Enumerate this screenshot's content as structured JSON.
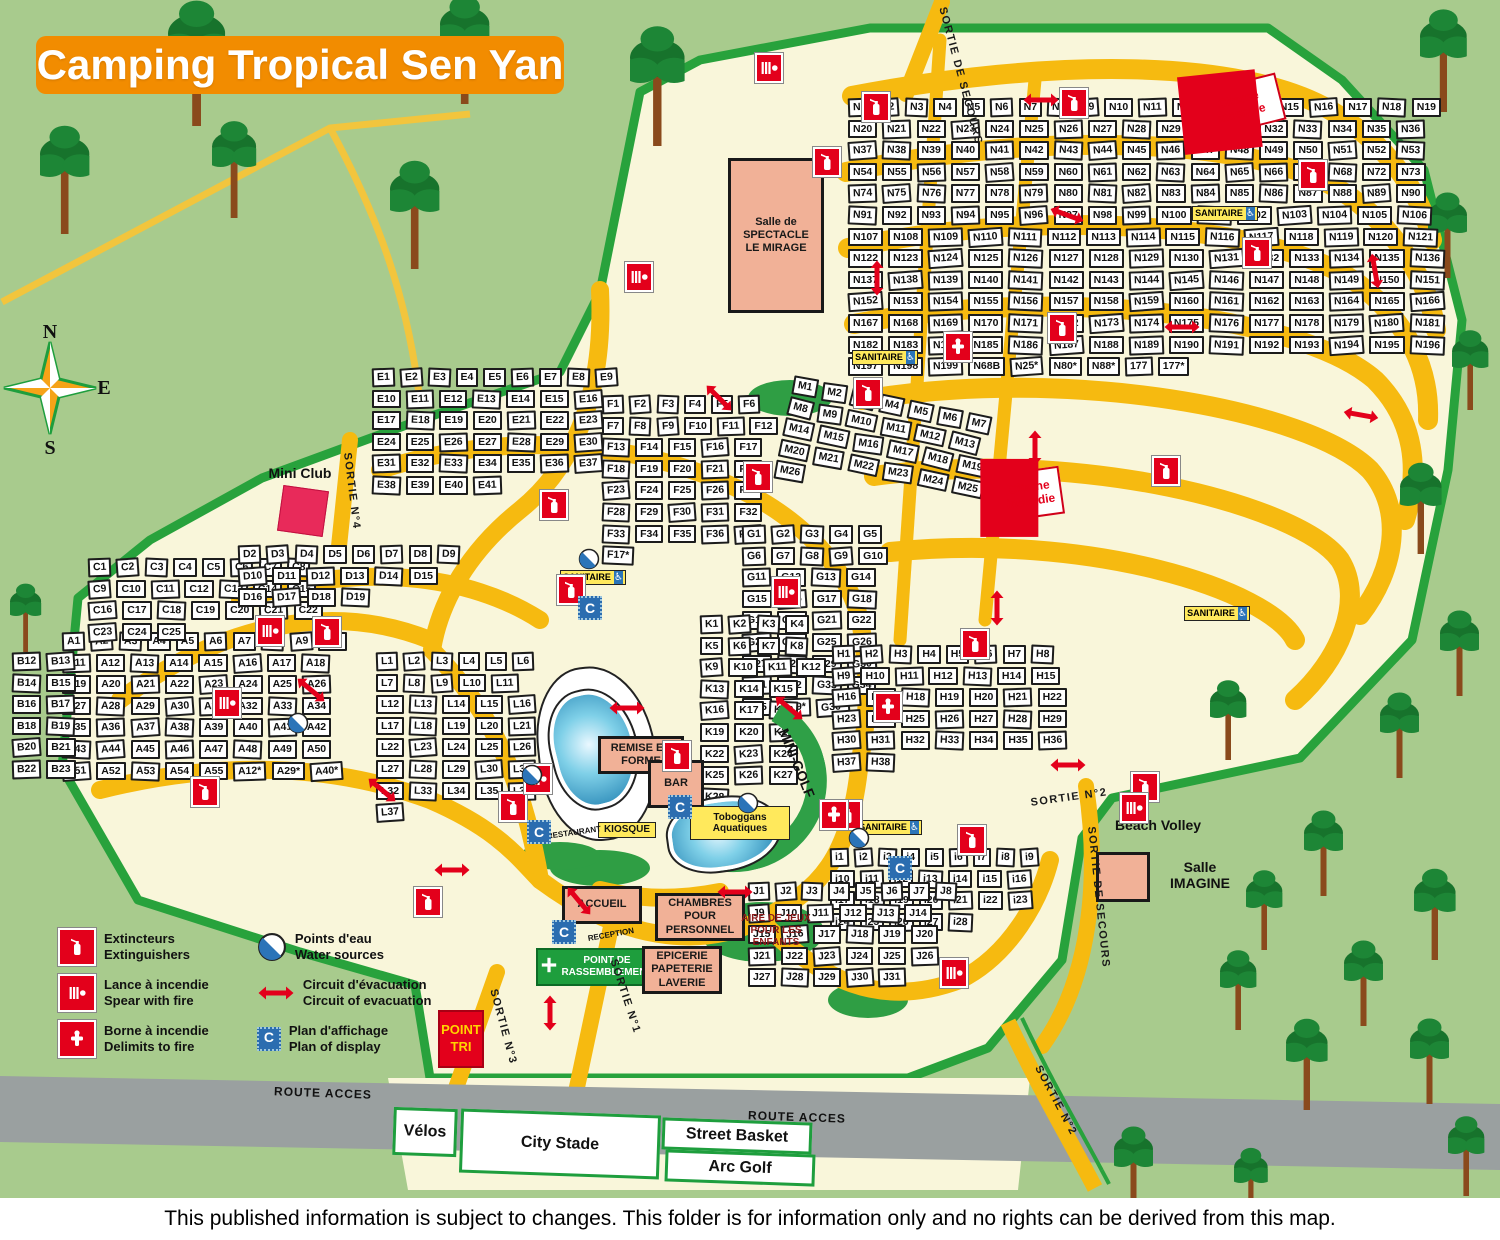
{
  "title": "Camping Tropical Sen Yan",
  "footer": "This published information is subject to changes. This folder is for information only and no rights can be derived from this map.",
  "compass": {
    "n": "N",
    "e": "E",
    "s": "S"
  },
  "icons": {
    "display_plan_glyph": "C",
    "handicap_glyph": "♿"
  },
  "colors": {
    "grass": "#a8cb8d",
    "cream": "#f9f6da",
    "road_yellow": "#f6ba10",
    "road_grey": "#9aa0a0",
    "boundary_green": "#28a23c",
    "accent_red": "#e3001b",
    "building_salmon": "#f1b197",
    "title_orange": "#f28c00",
    "badge_blue": "#2b6db0"
  },
  "legend": {
    "items": [
      {
        "icon": "extinguisher-icon",
        "fr": "Extincteurs",
        "en": "Extinguishers"
      },
      {
        "icon": "fire-lance-icon",
        "fr": "Lance à incendie",
        "en": "Spear with fire"
      },
      {
        "icon": "fire-hydrant-icon",
        "fr": "Borne à incendie",
        "en": "Delimits to fire"
      },
      {
        "icon": "water-point-icon",
        "fr": "Points d'eau",
        "en": "Water sources"
      },
      {
        "icon": "evacuation-arrow-icon",
        "fr": "Circuit d'évacuation",
        "en": "Circuit of evacuation"
      },
      {
        "icon": "display-plan-icon",
        "fr": "Plan d'affichage",
        "en": "Plan of display"
      }
    ]
  },
  "zones": [
    {
      "id": "zone-a",
      "letter": "A",
      "x": 62,
      "y": 632,
      "w": 300,
      "h": 330,
      "rot": 0,
      "ranges": [
        [
          1,
          55
        ]
      ],
      "specials": [
        "A12*",
        "A29*",
        "A40*"
      ]
    },
    {
      "id": "zone-b",
      "letter": "B",
      "x": 12,
      "y": 652,
      "w": 80,
      "h": 235,
      "rot": 0,
      "ranges": [
        [
          12,
          23
        ]
      ],
      "specials": []
    },
    {
      "id": "zone-c",
      "letter": "C",
      "x": 88,
      "y": 558,
      "w": 235,
      "h": 92,
      "rot": 0,
      "ranges": [
        [
          1,
          25
        ]
      ],
      "specials": []
    },
    {
      "id": "zone-d",
      "letter": "D",
      "x": 238,
      "y": 545,
      "w": 230,
      "h": 95,
      "rot": 0,
      "ranges": [
        [
          2,
          19
        ]
      ],
      "specials": []
    },
    {
      "id": "zone-e",
      "letter": "E",
      "x": 372,
      "y": 368,
      "w": 250,
      "h": 250,
      "rot": 0,
      "ranges": [
        [
          1,
          41
        ]
      ],
      "specials": []
    },
    {
      "id": "zone-f",
      "letter": "F",
      "x": 602,
      "y": 395,
      "w": 185,
      "h": 235,
      "rot": 0,
      "ranges": [
        [
          1,
          37
        ]
      ],
      "specials": [
        "F17*"
      ]
    },
    {
      "id": "zone-g",
      "letter": "G",
      "x": 742,
      "y": 525,
      "w": 165,
      "h": 195,
      "rot": 0,
      "ranges": [
        [
          1,
          35
        ]
      ],
      "specials": [
        "G29*",
        "G30*"
      ]
    },
    {
      "id": "zone-h",
      "letter": "H",
      "x": 832,
      "y": 645,
      "w": 245,
      "h": 225,
      "rot": 0,
      "ranges": [
        [
          1,
          38
        ]
      ],
      "specials": []
    },
    {
      "id": "zone-i",
      "letter": "i",
      "x": 830,
      "y": 848,
      "w": 225,
      "h": 210,
      "rot": 0,
      "ranges": [
        [
          1,
          28
        ]
      ],
      "specials": []
    },
    {
      "id": "zone-j",
      "letter": "J",
      "x": 748,
      "y": 882,
      "w": 215,
      "h": 180,
      "rot": 0,
      "ranges": [
        [
          1,
          31
        ]
      ],
      "specials": []
    },
    {
      "id": "zone-k",
      "letter": "K",
      "x": 700,
      "y": 615,
      "w": 132,
      "h": 195,
      "rot": 0,
      "ranges": [
        [
          1,
          28
        ]
      ],
      "specials": []
    },
    {
      "id": "zone-l",
      "letter": "L",
      "x": 376,
      "y": 652,
      "w": 175,
      "h": 160,
      "rot": 0,
      "ranges": [
        [
          1,
          37
        ]
      ],
      "specials": []
    },
    {
      "id": "zone-m",
      "letter": "M",
      "x": 795,
      "y": 375,
      "w": 230,
      "h": 260,
      "rot": 12,
      "ranges": [
        [
          1,
          26
        ]
      ],
      "specials": []
    },
    {
      "id": "zone-n",
      "letter": "N",
      "x": 848,
      "y": 98,
      "w": 600,
      "h": 560,
      "rot": 0,
      "ranges": [
        [
          1,
          68
        ],
        [
          72,
          199
        ]
      ],
      "specials": [
        "N68B",
        "N25*",
        "N80*",
        "N88*",
        "177",
        "177*"
      ]
    }
  ],
  "facilities": [
    {
      "id": "salle-spectacle",
      "kind": "building",
      "lines": [
        "Salle de",
        "SPECTACLE",
        "LE MIRAGE"
      ],
      "x": 728,
      "y": 158,
      "w": 96,
      "h": 155,
      "rot": 0
    },
    {
      "id": "mini-club-label",
      "kind": "plain-label",
      "lines": [
        "Mini Club"
      ],
      "x": 258,
      "y": 464,
      "w": 84,
      "h": 18,
      "rot": 0
    },
    {
      "id": "mini-club",
      "kind": "pink-square",
      "lines": [],
      "x": 280,
      "y": 488,
      "w": 46,
      "h": 46,
      "rot": 8
    },
    {
      "id": "pool-main",
      "kind": "pool-white",
      "lines": [],
      "x": 538,
      "y": 666,
      "w": 118,
      "h": 175,
      "rot": -6
    },
    {
      "id": "pool-blue-main",
      "kind": "pool-blue",
      "lines": [],
      "x": 552,
      "y": 690,
      "w": 84,
      "h": 118,
      "rot": -14
    },
    {
      "id": "mini-golf-band",
      "kind": "golf-band",
      "lines": [],
      "x": 642,
      "y": 692,
      "w": 185,
      "h": 180,
      "rot": 0
    },
    {
      "id": "pool-toboggan",
      "kind": "pool-blue",
      "lines": [],
      "x": 668,
      "y": 798,
      "w": 112,
      "h": 72,
      "rot": -8
    },
    {
      "id": "remise-en-forme",
      "kind": "building",
      "lines": [
        "REMISE EN",
        "FORME"
      ],
      "x": 598,
      "y": 736,
      "w": 86,
      "h": 38,
      "rot": 0
    },
    {
      "id": "bar",
      "kind": "building",
      "lines": [
        "BAR"
      ],
      "x": 648,
      "y": 760,
      "w": 56,
      "h": 48,
      "rot": 0
    },
    {
      "id": "kiosque",
      "kind": "yellow-label",
      "lines": [
        "KIOSQUE"
      ],
      "x": 598,
      "y": 822,
      "w": 58,
      "h": 16,
      "rot": 0
    },
    {
      "id": "restaurant-label",
      "kind": "plain-label-small",
      "lines": [
        "RESTAURANT"
      ],
      "x": 543,
      "y": 828,
      "w": 62,
      "h": 10,
      "rot": -8
    },
    {
      "id": "toboggans-label",
      "kind": "yellow-label",
      "lines": [
        "Toboggans",
        "Aquatiques"
      ],
      "x": 690,
      "y": 806,
      "w": 100,
      "h": 34,
      "rot": 0
    },
    {
      "id": "mini-golf-label",
      "kind": "plain-label",
      "lines": [
        "MINI-GOLF"
      ],
      "x": 752,
      "y": 756,
      "w": 90,
      "h": 14,
      "rot": 68
    },
    {
      "id": "accueil",
      "kind": "building",
      "lines": [
        "ACCUEIL"
      ],
      "x": 562,
      "y": 886,
      "w": 80,
      "h": 38,
      "rot": 0
    },
    {
      "id": "reception-label",
      "kind": "plain-label-small",
      "lines": [
        "RECEPTION"
      ],
      "x": 576,
      "y": 930,
      "w": 70,
      "h": 10,
      "rot": -10
    },
    {
      "id": "point-rassemblement",
      "kind": "green-box",
      "lines": [
        "POINT DE",
        "RASSEMBLEMENT"
      ],
      "x": 536,
      "y": 948,
      "w": 122,
      "h": 38,
      "rot": 0
    },
    {
      "id": "chambres-personnel",
      "kind": "building",
      "lines": [
        "CHAMBRES",
        "POUR",
        "PERSONNEL"
      ],
      "x": 655,
      "y": 893,
      "w": 90,
      "h": 48,
      "rot": 0
    },
    {
      "id": "epicerie",
      "kind": "building",
      "lines": [
        "EPICERIE",
        "PAPETERIE",
        "LAVERIE"
      ],
      "x": 642,
      "y": 946,
      "w": 80,
      "h": 48,
      "rot": 0
    },
    {
      "id": "aire-de-jeux",
      "kind": "darkred-label",
      "lines": [
        "AIRE DE JEUX",
        "POUR LES ENFANTS"
      ],
      "x": 726,
      "y": 916,
      "w": 100,
      "h": 30,
      "rot": 0
    },
    {
      "id": "point-tri",
      "kind": "red-box",
      "lines": [
        "POINT",
        "TRI"
      ],
      "x": 438,
      "y": 1010,
      "w": 46,
      "h": 58,
      "rot": 0
    },
    {
      "id": "beach-volley-label",
      "kind": "plain-label",
      "lines": [
        "Beach Volley"
      ],
      "x": 1102,
      "y": 816,
      "w": 112,
      "h": 18,
      "rot": 0
    },
    {
      "id": "salle-imagine",
      "kind": "building",
      "lines": [],
      "x": 1096,
      "y": 852,
      "w": 54,
      "h": 50,
      "rot": 0
    },
    {
      "id": "salle-imagine-label",
      "kind": "plain-label",
      "lines": [
        "Salle",
        "IMAGINE"
      ],
      "x": 1158,
      "y": 858,
      "w": 84,
      "h": 34,
      "rot": 0
    },
    {
      "id": "citerne-incendie-1",
      "kind": "citerne",
      "lines": [
        "Citerne",
        "incendie"
      ],
      "x": 1198,
      "y": 82,
      "w": 84,
      "h": 48,
      "rot": -14
    },
    {
      "id": "citerne-incendie-2",
      "kind": "citerne",
      "lines": [
        "Citerne",
        "incendie"
      ],
      "x": 998,
      "y": 470,
      "w": 64,
      "h": 48,
      "rot": -8
    },
    {
      "id": "sanitaire-1",
      "kind": "sanitaire",
      "lines": [
        "SANITAIRE"
      ],
      "x": 560,
      "y": 570,
      "w": 66,
      "h": 15,
      "rot": 0
    },
    {
      "id": "sanitaire-2",
      "kind": "sanitaire",
      "lines": [
        "SANITAIRE"
      ],
      "x": 852,
      "y": 350,
      "w": 66,
      "h": 15,
      "rot": 0
    },
    {
      "id": "sanitaire-3",
      "kind": "sanitaire",
      "lines": [
        "SANITAIRE"
      ],
      "x": 1184,
      "y": 606,
      "w": 66,
      "h": 15,
      "rot": 0
    },
    {
      "id": "sanitaire-4",
      "kind": "sanitaire",
      "lines": [
        "SANITAIRE"
      ],
      "x": 856,
      "y": 820,
      "w": 66,
      "h": 15,
      "rot": 0
    },
    {
      "id": "sanitaire-5",
      "kind": "sanitaire",
      "lines": [
        "SANITAIRE"
      ],
      "x": 1192,
      "y": 206,
      "w": 66,
      "h": 15,
      "rot": 0
    },
    {
      "id": "velos",
      "kind": "sport-box",
      "lines": [
        "Vélos"
      ],
      "x": 393,
      "y": 1108,
      "w": 64,
      "h": 48,
      "rot": 2
    },
    {
      "id": "city-stade",
      "kind": "sport-box",
      "lines": [
        "City Stade"
      ],
      "x": 460,
      "y": 1112,
      "w": 200,
      "h": 64,
      "rot": 2
    },
    {
      "id": "street-basket",
      "kind": "sport-box",
      "lines": [
        "Street Basket"
      ],
      "x": 662,
      "y": 1120,
      "w": 150,
      "h": 32,
      "rot": 2
    },
    {
      "id": "arc-golf",
      "kind": "sport-box",
      "lines": [
        "Arc Golf"
      ],
      "x": 665,
      "y": 1152,
      "w": 150,
      "h": 32,
      "rot": 2
    },
    {
      "id": "route-acces-1",
      "kind": "road-label",
      "lines": [
        "ROUTE ACCES"
      ],
      "x": 268,
      "y": 1086,
      "w": 110,
      "h": 14,
      "rot": 2
    },
    {
      "id": "route-acces-2",
      "kind": "road-label",
      "lines": [
        "ROUTE ACCES"
      ],
      "x": 742,
      "y": 1110,
      "w": 110,
      "h": 14,
      "rot": 2
    }
  ],
  "road_labels": [
    {
      "text": "SORTIE DE SECOURS",
      "x": 947,
      "y": 6,
      "rot": 75
    },
    {
      "text": "SORTIE N°4",
      "x": 352,
      "y": 452,
      "rot": 83
    },
    {
      "text": "SORTIE N°3",
      "x": 498,
      "y": 988,
      "rot": 75
    },
    {
      "text": "SORTIE N°1",
      "x": 618,
      "y": 958,
      "rot": 72
    },
    {
      "text": "SORTIE N°2",
      "x": 1042,
      "y": 1064,
      "rot": 62
    },
    {
      "text": "SORTIE N°2",
      "x": 1030,
      "y": 798,
      "rot": -8
    },
    {
      "text": "SORTIE DE SECOURS",
      "x": 1096,
      "y": 826,
      "rot": 84
    }
  ],
  "markers": [
    {
      "type": "extinguisher",
      "x": 862,
      "y": 92,
      "rot": 0
    },
    {
      "type": "extinguisher",
      "x": 813,
      "y": 147,
      "rot": 0
    },
    {
      "type": "extinguisher",
      "x": 1060,
      "y": 88,
      "rot": 0
    },
    {
      "type": "extinguisher",
      "x": 1299,
      "y": 160,
      "rot": 0
    },
    {
      "type": "extinguisher",
      "x": 1243,
      "y": 238,
      "rot": 0
    },
    {
      "type": "extinguisher",
      "x": 1152,
      "y": 456,
      "rot": 0
    },
    {
      "type": "extinguisher",
      "x": 961,
      "y": 629,
      "rot": 0
    },
    {
      "type": "extinguisher",
      "x": 854,
      "y": 378,
      "rot": 0
    },
    {
      "type": "extinguisher",
      "x": 744,
      "y": 462,
      "rot": 0
    },
    {
      "type": "extinguisher",
      "x": 540,
      "y": 490,
      "rot": 0
    },
    {
      "type": "extinguisher",
      "x": 557,
      "y": 575,
      "rot": 0
    },
    {
      "type": "extinguisher",
      "x": 499,
      "y": 792,
      "rot": 0
    },
    {
      "type": "extinguisher",
      "x": 414,
      "y": 887,
      "rot": 0
    },
    {
      "type": "extinguisher",
      "x": 191,
      "y": 777,
      "rot": 0
    },
    {
      "type": "extinguisher",
      "x": 313,
      "y": 617,
      "rot": 0
    },
    {
      "type": "extinguisher",
      "x": 663,
      "y": 741,
      "rot": 0
    },
    {
      "type": "extinguisher",
      "x": 834,
      "y": 800,
      "rot": 0
    },
    {
      "type": "extinguisher",
      "x": 1131,
      "y": 772,
      "rot": 0
    },
    {
      "type": "extinguisher",
      "x": 958,
      "y": 825,
      "rot": 0
    },
    {
      "type": "extinguisher",
      "x": 1048,
      "y": 313,
      "rot": 0
    },
    {
      "type": "lance",
      "x": 755,
      "y": 53,
      "rot": 0
    },
    {
      "type": "lance",
      "x": 625,
      "y": 262,
      "rot": 0
    },
    {
      "type": "lance",
      "x": 256,
      "y": 616,
      "rot": 0
    },
    {
      "type": "lance",
      "x": 213,
      "y": 688,
      "rot": 0
    },
    {
      "type": "lance",
      "x": 524,
      "y": 764,
      "rot": 0
    },
    {
      "type": "lance",
      "x": 772,
      "y": 577,
      "rot": 0
    },
    {
      "type": "lance",
      "x": 1120,
      "y": 793,
      "rot": 0
    },
    {
      "type": "lance",
      "x": 940,
      "y": 958,
      "rot": 0
    },
    {
      "type": "hydrant",
      "x": 820,
      "y": 800,
      "rot": 0
    },
    {
      "type": "hydrant",
      "x": 874,
      "y": 692,
      "rot": 0
    },
    {
      "type": "hydrant",
      "x": 944,
      "y": 332,
      "rot": 0
    },
    {
      "type": "water",
      "x": 287,
      "y": 712,
      "rot": 0
    },
    {
      "type": "water",
      "x": 521,
      "y": 764,
      "rot": 0
    },
    {
      "type": "water",
      "x": 848,
      "y": 827,
      "rot": 0
    },
    {
      "type": "water",
      "x": 737,
      "y": 792,
      "rot": 0
    },
    {
      "type": "water",
      "x": 578,
      "y": 548,
      "rot": 0
    },
    {
      "type": "cbadge",
      "x": 552,
      "y": 920,
      "rot": 0
    },
    {
      "type": "cbadge",
      "x": 527,
      "y": 820,
      "rot": 0
    },
    {
      "type": "cbadge",
      "x": 578,
      "y": 596,
      "rot": 0
    },
    {
      "type": "cbadge",
      "x": 668,
      "y": 795,
      "rot": 0
    },
    {
      "type": "cbadge",
      "x": 888,
      "y": 856,
      "rot": 0
    },
    {
      "type": "arrow",
      "x": 1022,
      "y": 92,
      "rot": 0
    },
    {
      "type": "arrow",
      "x": 858,
      "y": 270,
      "rot": 90
    },
    {
      "type": "arrow",
      "x": 1048,
      "y": 207,
      "rot": 20
    },
    {
      "type": "arrow",
      "x": 1163,
      "y": 319,
      "rot": 0
    },
    {
      "type": "arrow",
      "x": 1356,
      "y": 263,
      "rot": 80
    },
    {
      "type": "arrow",
      "x": 1342,
      "y": 407,
      "rot": 10
    },
    {
      "type": "arrow",
      "x": 1016,
      "y": 440,
      "rot": 90
    },
    {
      "type": "arrow",
      "x": 978,
      "y": 600,
      "rot": 90
    },
    {
      "type": "arrow",
      "x": 770,
      "y": 700,
      "rot": 40
    },
    {
      "type": "arrow",
      "x": 608,
      "y": 700,
      "rot": 0
    },
    {
      "type": "arrow",
      "x": 560,
      "y": 893,
      "rot": 50
    },
    {
      "type": "arrow",
      "x": 716,
      "y": 884,
      "rot": 0
    },
    {
      "type": "arrow",
      "x": 433,
      "y": 862,
      "rot": 0
    },
    {
      "type": "arrow",
      "x": 363,
      "y": 782,
      "rot": 40
    },
    {
      "type": "arrow",
      "x": 1049,
      "y": 757,
      "rot": 0
    },
    {
      "type": "arrow",
      "x": 531,
      "y": 1005,
      "rot": 90
    },
    {
      "type": "arrow",
      "x": 292,
      "y": 682,
      "rot": 40
    },
    {
      "type": "arrow",
      "x": 700,
      "y": 390,
      "rot": 45
    }
  ]
}
